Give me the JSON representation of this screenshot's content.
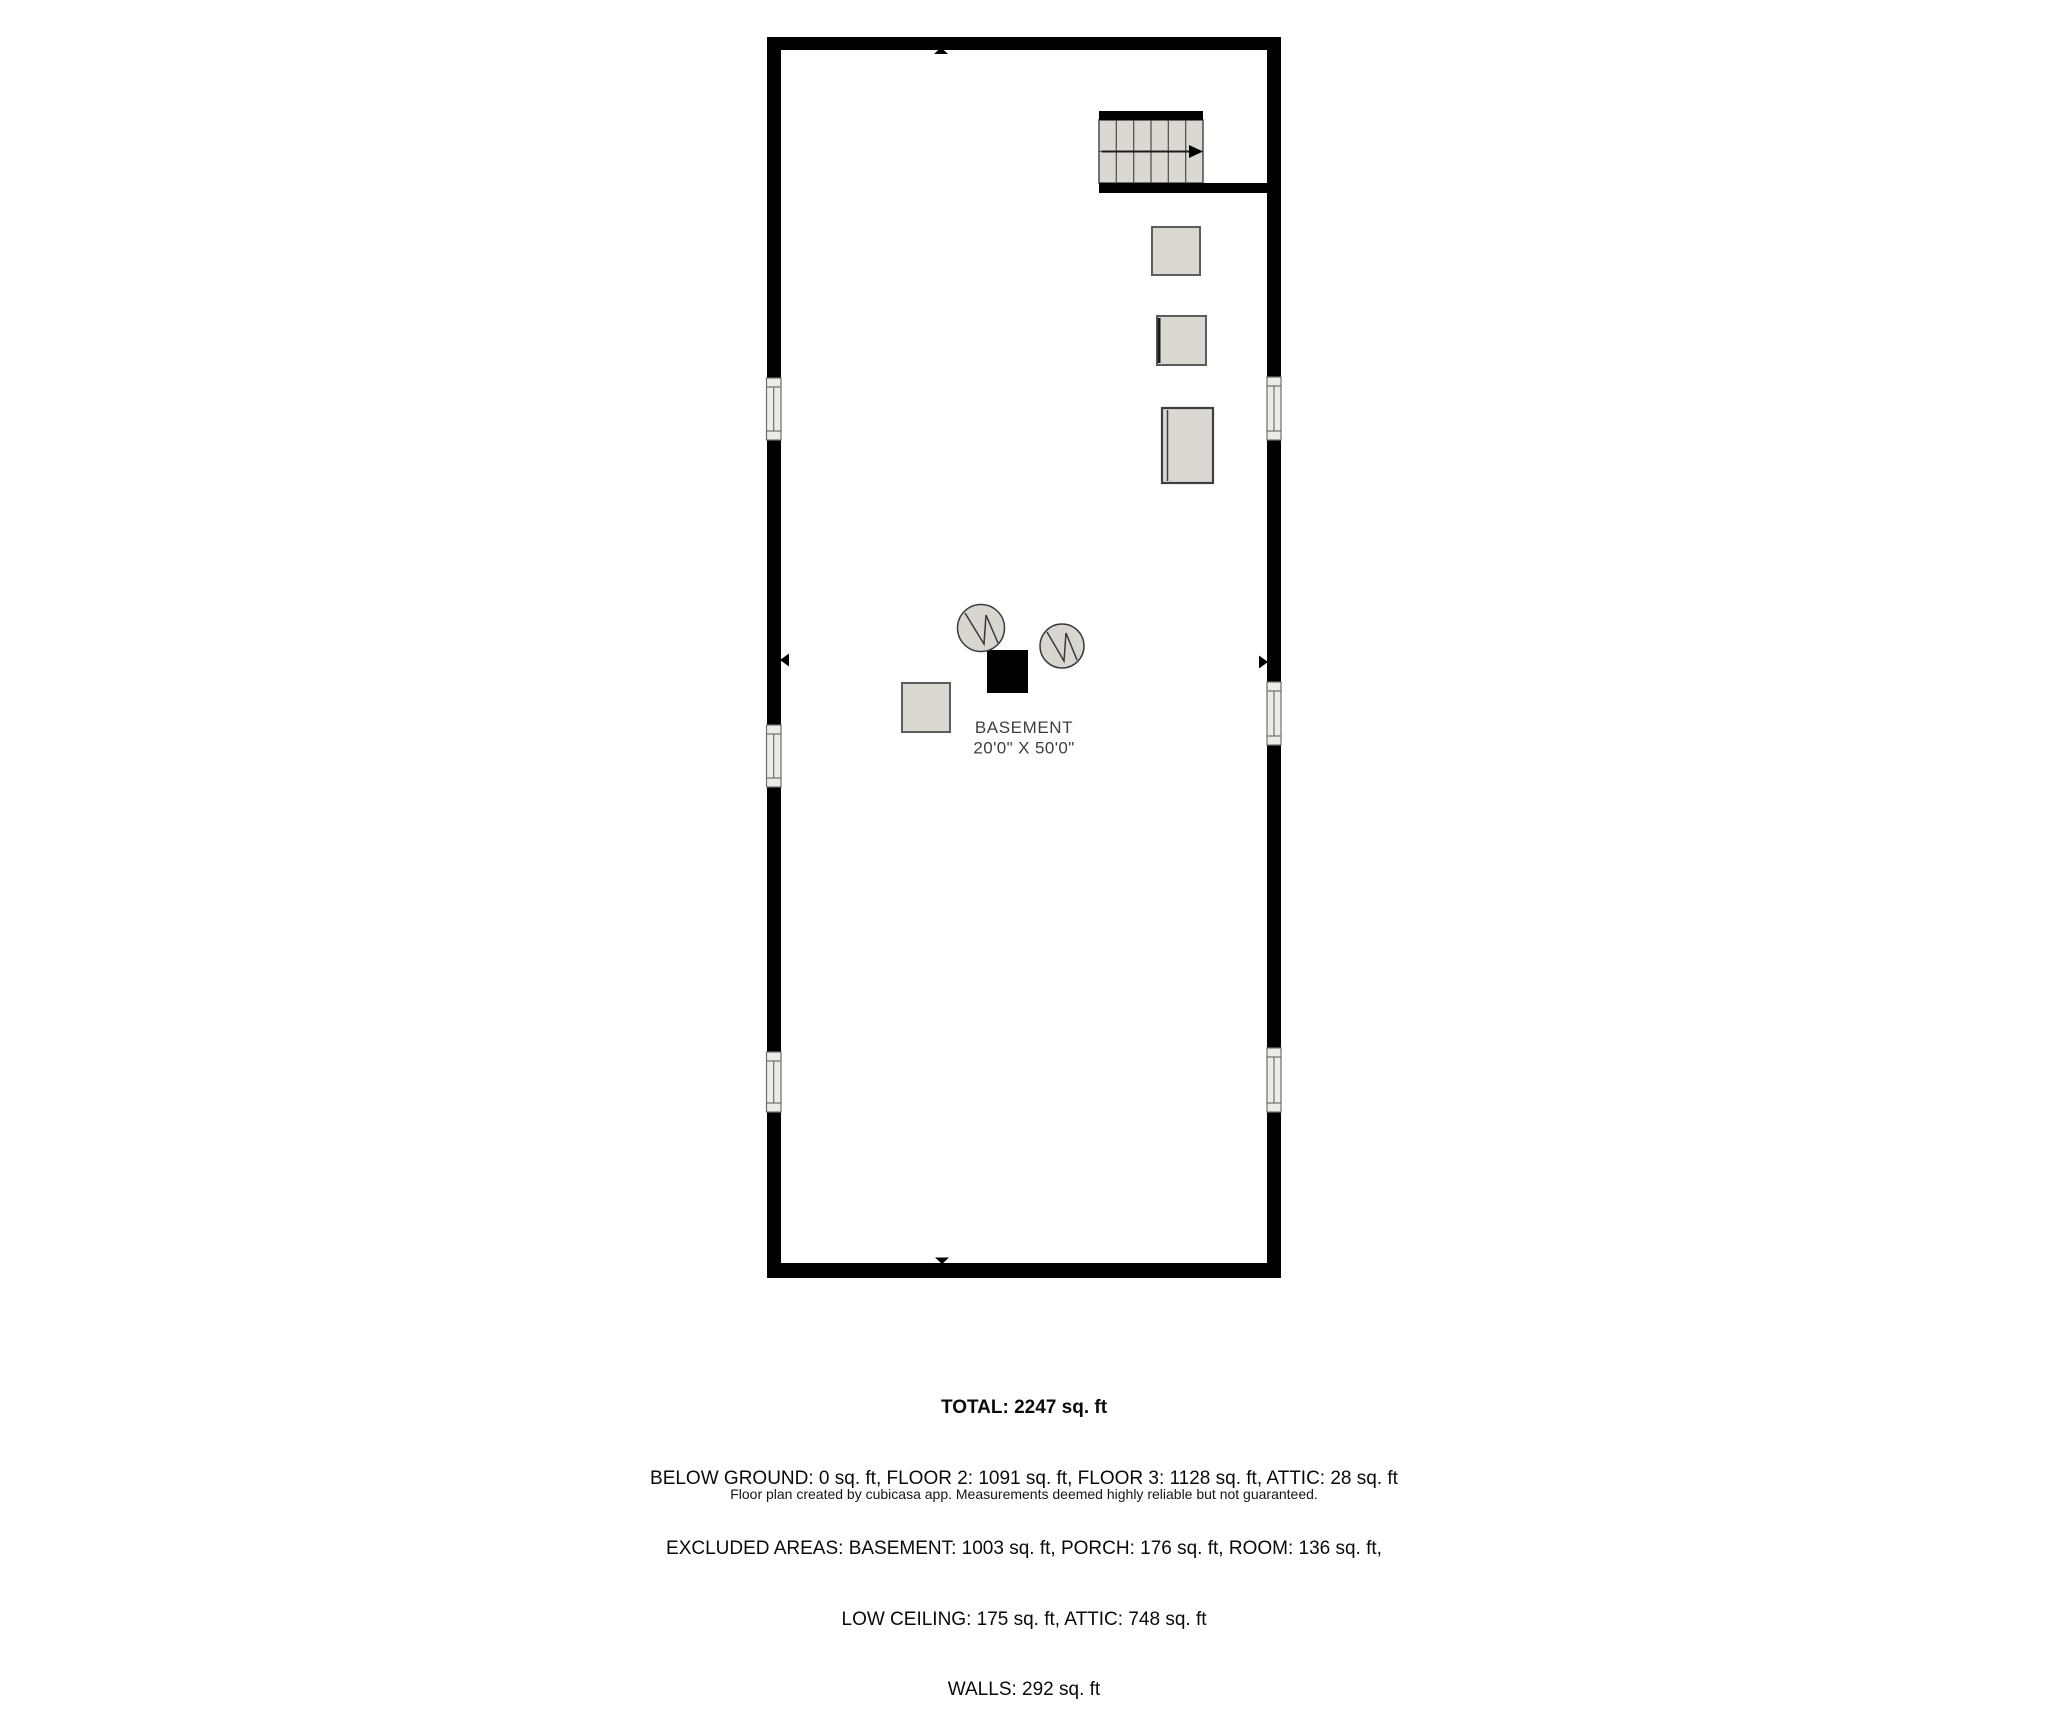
{
  "floor_plan": {
    "room_label": "BASEMENT",
    "room_dimensions": "20'0\" X 50'0\"",
    "colors": {
      "wall": "#000000",
      "fixture_fill": "#dbd8d2",
      "fixture_border": "#5c5c5c",
      "window_fill": "#edebe6",
      "window_frame": "#6e6e6e",
      "label_text": "#3f3f3f",
      "background": "#ffffff"
    },
    "symbols": {
      "staircase": "stairs-with-up-direction-arrow",
      "water_heater_circles": 2,
      "furnace_black_square": 1,
      "appliance_boxes": 4,
      "windows_left_wall": 3,
      "windows_right_wall": 3,
      "wall_direction_markers": 4
    }
  },
  "summary": {
    "total_line": "TOTAL: 2247 sq. ft",
    "breakdown_lines": [
      "BELOW GROUND: 0 sq. ft, FLOOR 2: 1091 sq. ft, FLOOR 3: 1128 sq. ft, ATTIC: 28 sq. ft",
      "EXCLUDED AREAS: BASEMENT: 1003 sq. ft, PORCH: 176 sq. ft, ROOM: 136 sq. ft,",
      "LOW CEILING: 175 sq. ft, ATTIC: 748 sq. ft",
      "WALLS: 292 sq. ft"
    ],
    "disclaimer": "Floor plan created by cubicasa app. Measurements deemed highly reliable but not guaranteed."
  }
}
